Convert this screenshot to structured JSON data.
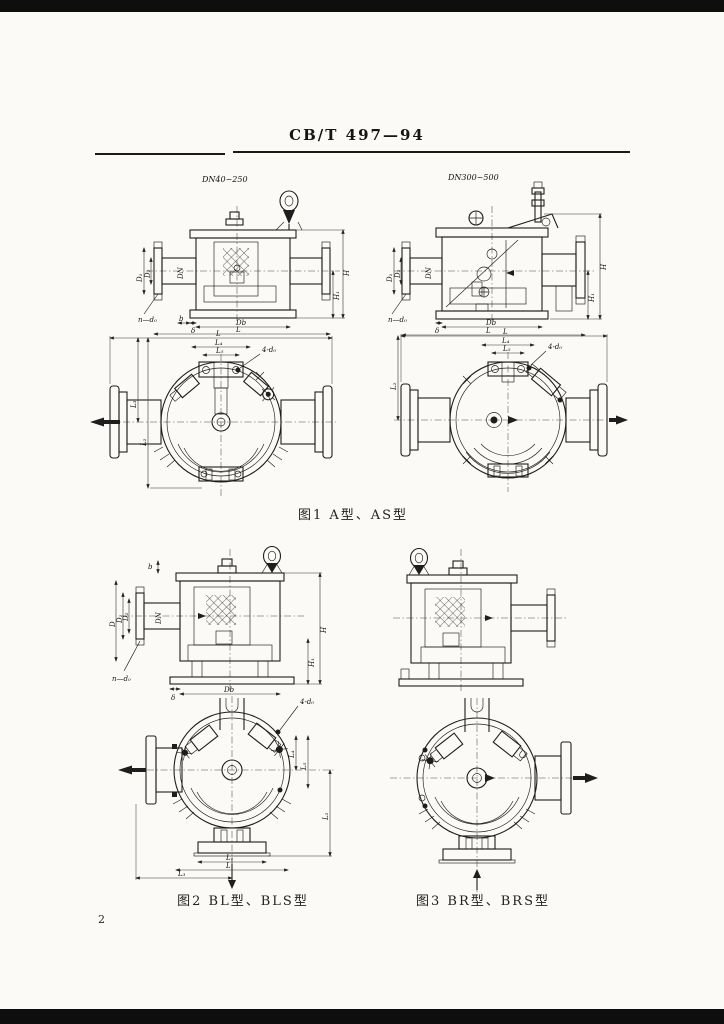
{
  "page": {
    "standard_code": "CB/T 497—94",
    "page_number": "2"
  },
  "figures": {
    "fig1": {
      "caption": "图1  A型、AS型",
      "left_dn": "DN40~250",
      "right_dn": "DN300~500"
    },
    "fig2": {
      "caption": "图2  BL型、BLS型"
    },
    "fig3": {
      "caption": "图3  BR型、BRS型"
    }
  },
  "dims": {
    "D": "D",
    "D1": "D₁",
    "D2": "D₂",
    "DN": "DN",
    "H": "H",
    "H1": "H₁",
    "b": "b",
    "delta": "δ",
    "Db": "Db",
    "L": "L",
    "L1": "L₁",
    "L2": "L₂",
    "L3": "L₃",
    "L4": "L₄",
    "L5": "L₅",
    "n_d0": "n—d₀",
    "four_d0": "4-d₀"
  }
}
